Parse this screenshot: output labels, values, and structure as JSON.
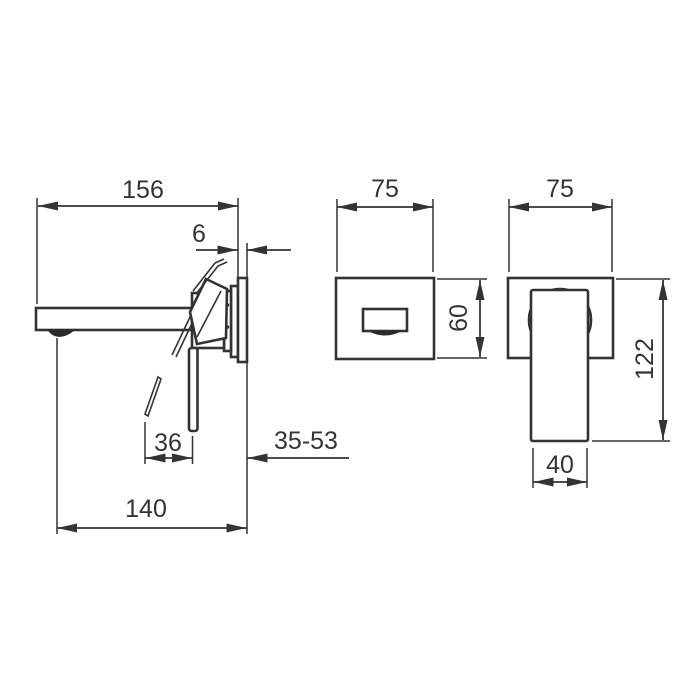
{
  "drawing": {
    "background": "#ffffff",
    "line_color": "#333333",
    "side_view": {
      "dims": {
        "spout_reach": "156",
        "plate_thickness": "6",
        "lever_travel": "36",
        "install_depth": "35-53",
        "spout_length": "140"
      }
    },
    "spout_front_view": {
      "dims": {
        "plate_width": "75",
        "plate_height": "60"
      }
    },
    "handle_front_view": {
      "dims": {
        "plate_width": "75",
        "overall_height": "122",
        "handle_width": "40"
      }
    }
  }
}
